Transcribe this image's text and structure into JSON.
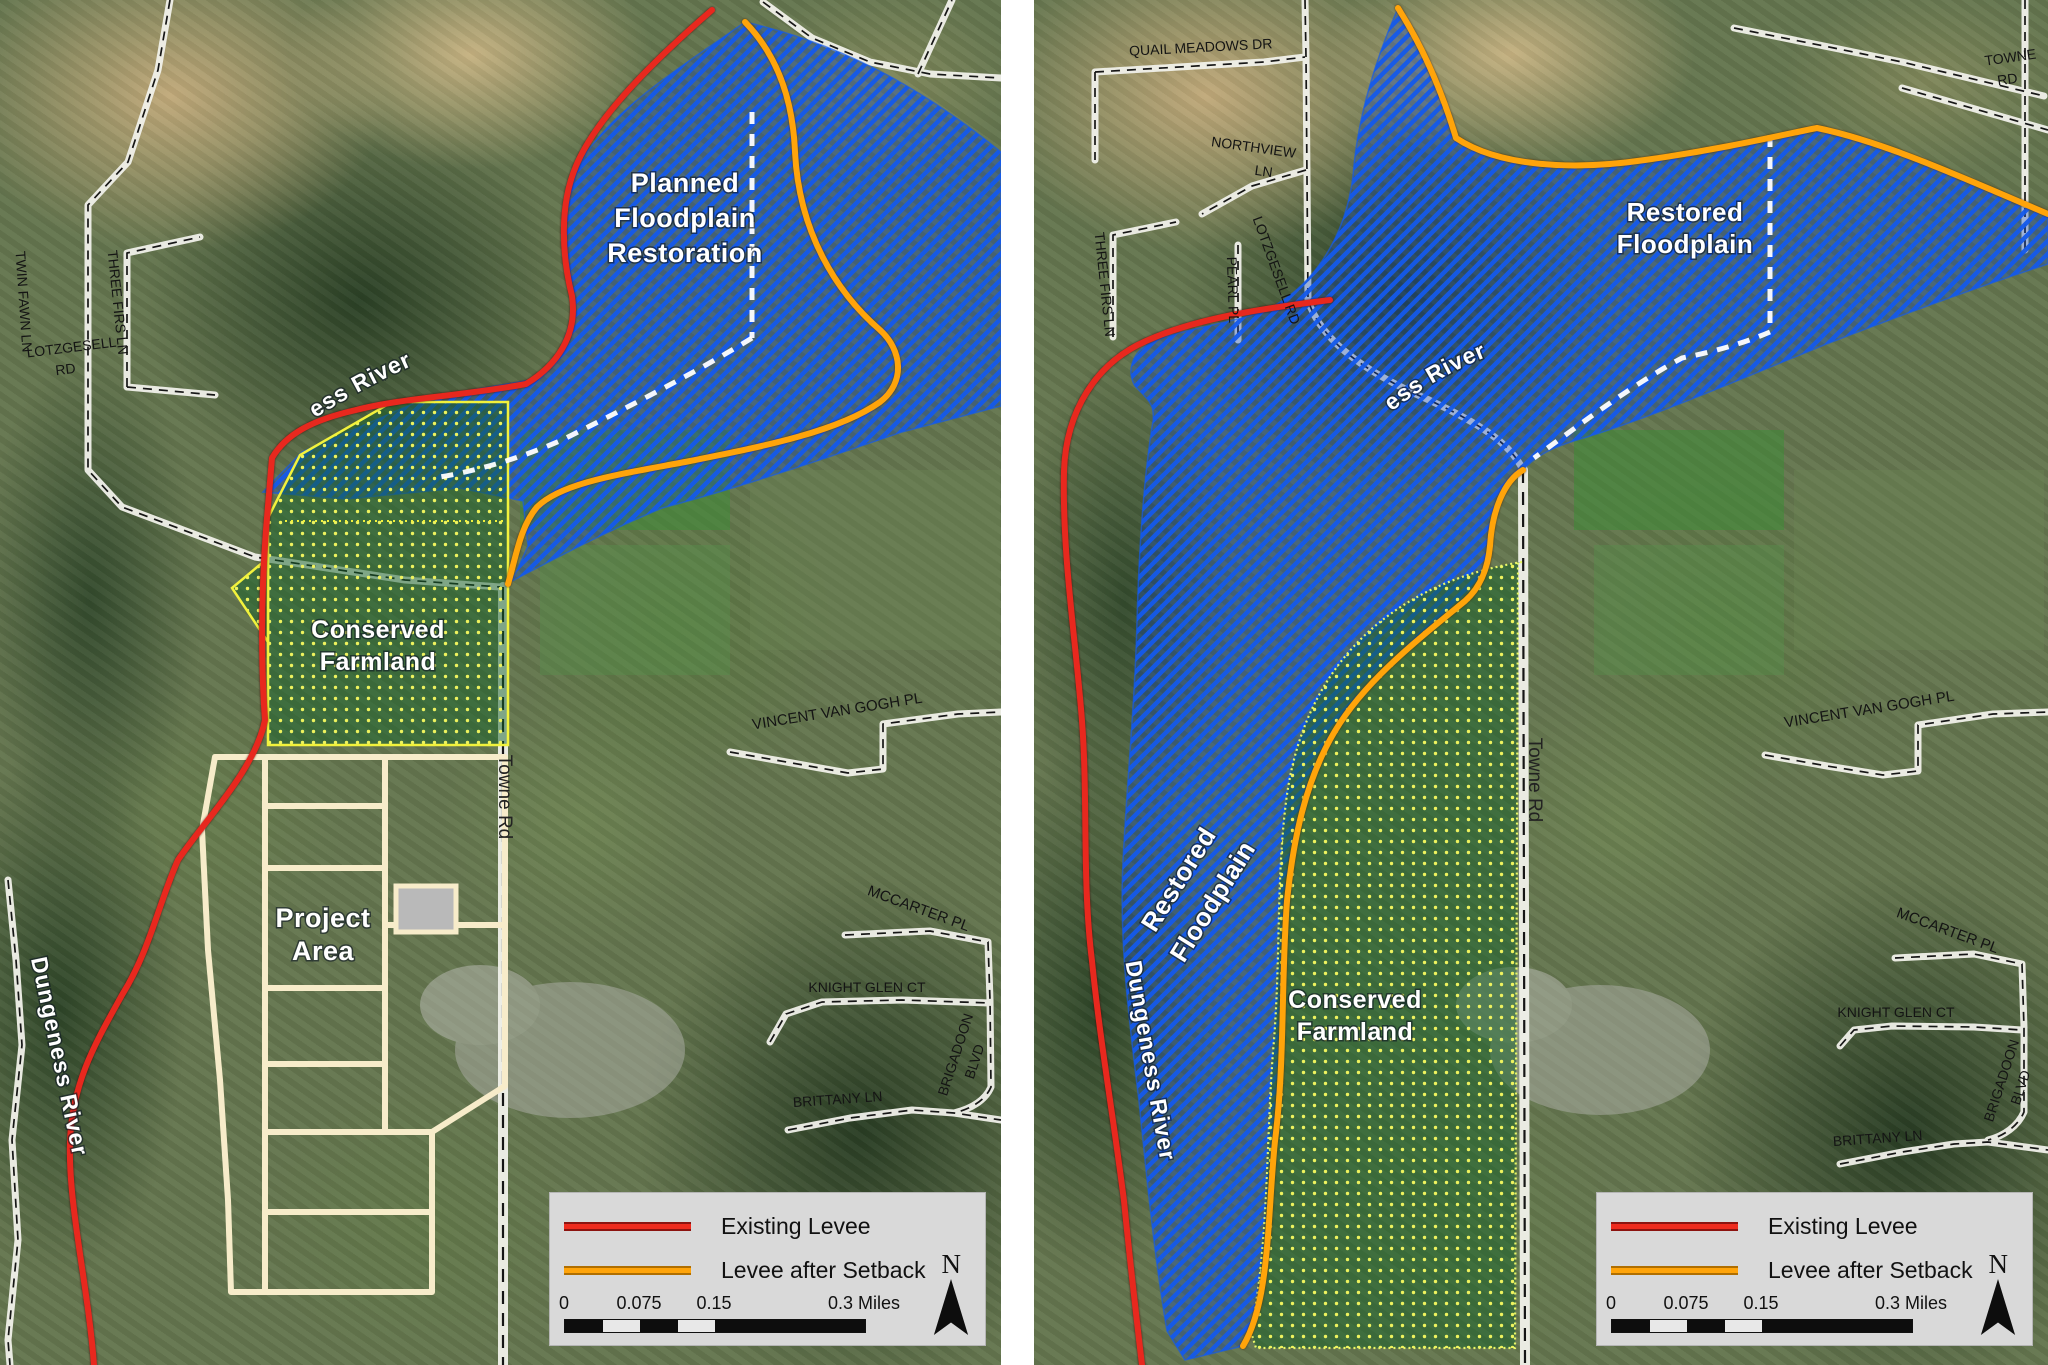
{
  "legend": {
    "existing_levee": "Existing Levee",
    "levee_after_setback": "Levee after Setback",
    "north": "N",
    "scale": {
      "t0": "0",
      "t1": "0.075",
      "t2": "0.15",
      "t3": "0.3 Miles"
    }
  },
  "left_map": {
    "floodplain": {
      "line1": "Planned",
      "line2": "Floodplain",
      "line3": "Restoration"
    },
    "farmland": {
      "line1": "Conserved",
      "line2": "Farmland"
    },
    "project": {
      "line1": "Project",
      "line2": "Area"
    },
    "river_top": "Dungeness River",
    "river_side": "Dungeness River",
    "roads": {
      "twin_fawn": "TWIN FAWN LN",
      "three_firs": "THREE FIRS LN",
      "lotzgesell_1": "LOTZGESELL",
      "lotzgesell_2": "RD",
      "vincent": "VINCENT VAN GOGH PL",
      "towne": "Towne Rd",
      "mccarter": "MCCARTER PL",
      "knight_glen": "KNIGHT GLEN CT",
      "brigadoon_1": "BRIGADOON",
      "brigadoon_2": "BLVD",
      "brittany": "BRITTANY LN"
    }
  },
  "right_map": {
    "floodplain": {
      "line1": "Restored",
      "line2": "Floodplain"
    },
    "floodplain_diag": {
      "line1": "Restored",
      "line2": "Floodplain"
    },
    "farmland": {
      "line1": "Conserved",
      "line2": "Farmland"
    },
    "river_top": "Dungeness River",
    "river_side": "Dungeness River",
    "roads": {
      "quail_meadows": "QUAIL MEADOWS DR",
      "northview_1": "NORTHVIEW",
      "northview_2": "LN",
      "three_firs": "THREE FIRS LN",
      "pearl": "PEARL PL",
      "lotzgesell": "LOTZGESELL RD",
      "towne_corner_1": "TOWNE",
      "towne_corner_2": "RD",
      "vincent": "VINCENT VAN GOGH PL",
      "towne": "Towne Rd",
      "mccarter": "MCCARTER PL",
      "knight_glen": "KNIGHT GLEN CT",
      "brigadoon_1": "BRIGADOON",
      "brigadoon_2": "BLVD",
      "brittany": "BRITTANY LN"
    }
  },
  "colors": {
    "existing_levee": "#e8281e",
    "levee_after_setback": "#ffa40a",
    "floodplain_hatch_blue": "#1459d8",
    "farmland_dot_yellow": "#eef35e",
    "project_outline_cream": "#f7ecca",
    "legend_background": "#d9d9d9"
  }
}
